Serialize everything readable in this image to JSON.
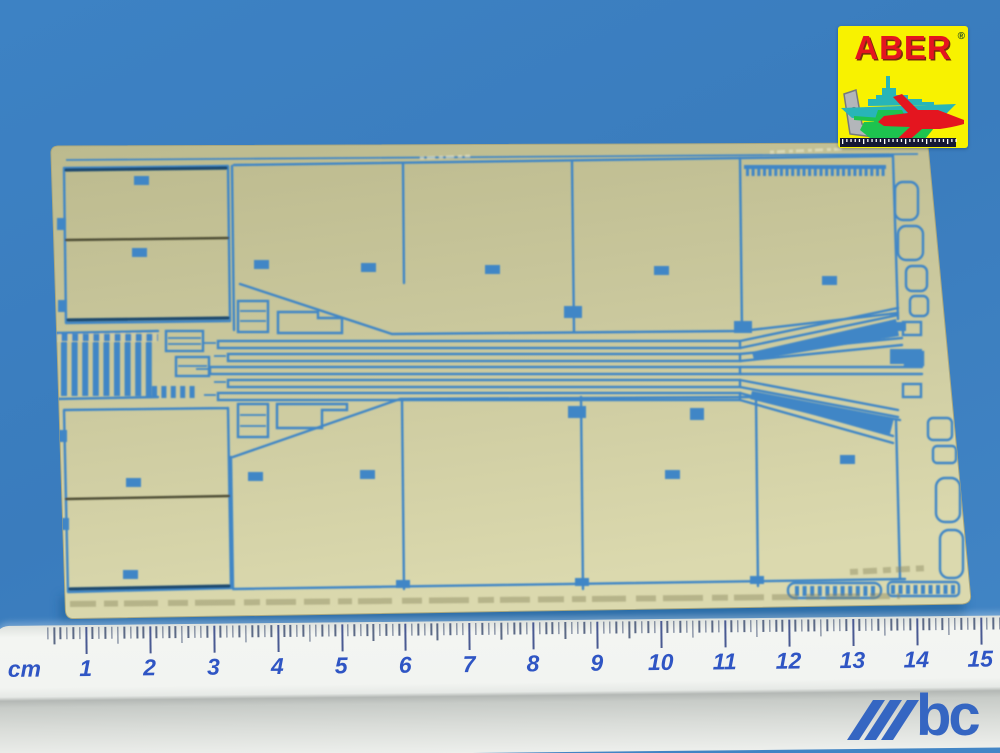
{
  "colors": {
    "background": "#3d82c4",
    "background_shadow": "#1f5d94",
    "brass": "#cbc99e",
    "etch": "#3f86c6",
    "logo_yellow": "#f8f200",
    "logo_red": "#e4151f",
    "ruler_numbers": "#2f55c4",
    "watermark": "#3566c2"
  },
  "logo": {
    "brand": "ABER",
    "registered": "®"
  },
  "ruler": {
    "unit": "cm",
    "marks": [
      "1",
      "2",
      "3",
      "4",
      "5",
      "6",
      "7",
      "8",
      "9",
      "10",
      "11",
      "12",
      "13",
      "14",
      "15"
    ]
  },
  "watermark": {
    "letters": "bc"
  }
}
